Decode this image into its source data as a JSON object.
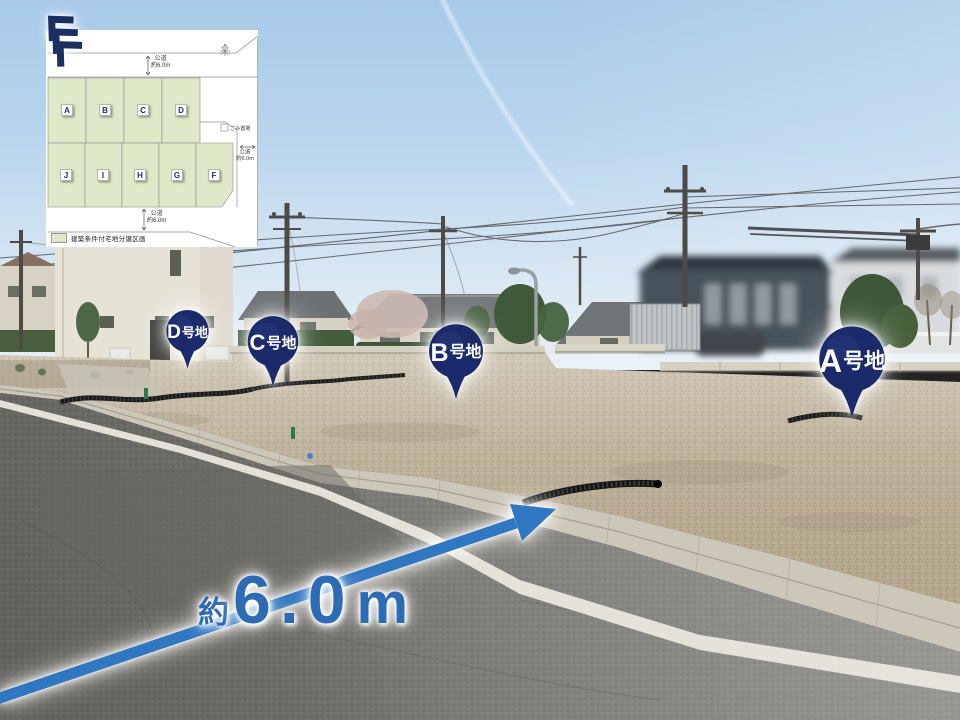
{
  "overlay": {
    "pins": [
      {
        "id": "A",
        "letter": "A",
        "suffix": "号地"
      },
      {
        "id": "B",
        "letter": "B",
        "suffix": "号地"
      },
      {
        "id": "C",
        "letter": "C",
        "suffix": "号地"
      },
      {
        "id": "D",
        "letter": "D",
        "suffix": "号地"
      }
    ],
    "road_width_label": {
      "prefix": "約",
      "value": "6.0",
      "unit": "m"
    }
  },
  "inset_map": {
    "lots_top": [
      "A",
      "B",
      "C",
      "D"
    ],
    "lots_bottom": [
      "J",
      "I",
      "H",
      "G",
      "F"
    ],
    "road_top": {
      "name": "公道",
      "width": "約6.0m"
    },
    "road_right": {
      "name": "公道",
      "width": "約6.0m"
    },
    "road_bottom": {
      "name": "公道",
      "width": "約6.0m"
    },
    "garbage_note": "ごみ置場",
    "legend_label": "建築条件付宅地分譲区画"
  },
  "colors": {
    "pin_navy": "#1a2a6b",
    "arrow_blue": "#3077c2",
    "measure_blue": "#2d6cb4",
    "lot_green": "#dfe9c8",
    "logo_navy": "#1c2f63"
  }
}
